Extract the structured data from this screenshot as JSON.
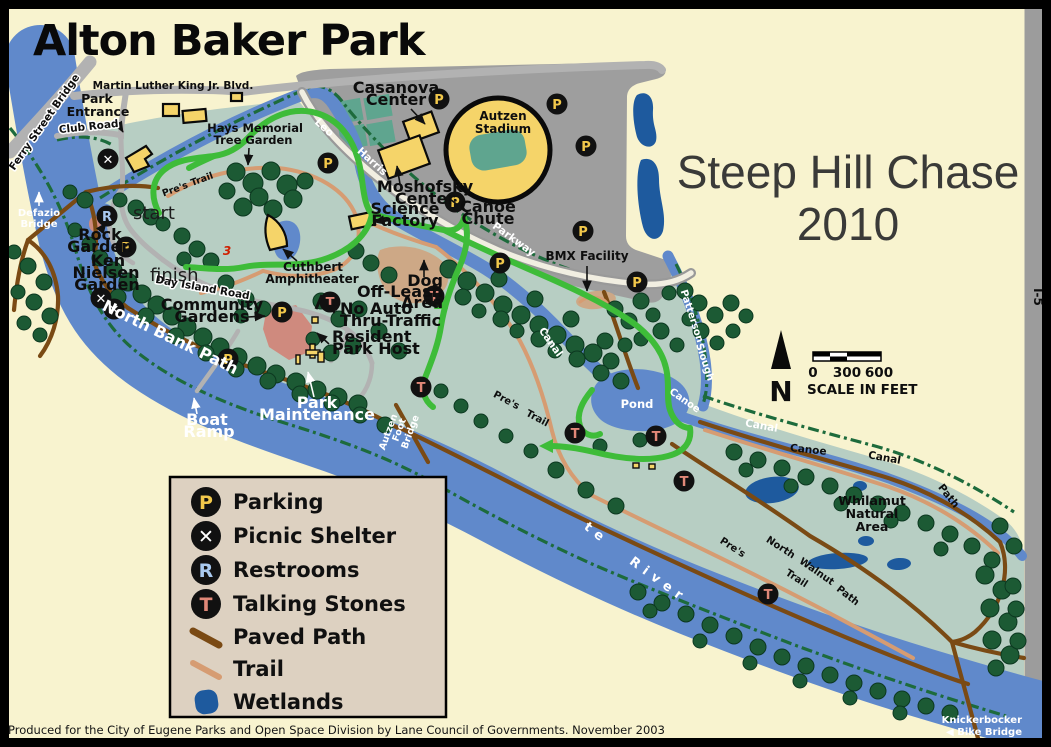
{
  "title": "Alton Baker Park",
  "event_overlay": {
    "line1": "Steep Hill Chase",
    "line2": "2010"
  },
  "credit": "Produced for the City of Eugene Parks and Open Space Division by Lane Council of Governments.  November 2003",
  "symbols": {
    "parking": "P",
    "picnic": "✕",
    "restroom": "R",
    "talking": "T"
  },
  "legend": {
    "items": [
      {
        "symbol": "P",
        "label": "Parking"
      },
      {
        "symbol": "✕",
        "label": "Picnic Shelter"
      },
      {
        "symbol": "R",
        "label": "Restrooms"
      },
      {
        "symbol": "T",
        "label": "Talking Stones"
      },
      {
        "label": "Paved Path"
      },
      {
        "label": "Trail"
      },
      {
        "label": "Wetlands"
      }
    ]
  },
  "compass": {
    "north": "N"
  },
  "scale_bar": {
    "t0": "0",
    "t300": "300",
    "t600": "600",
    "caption": "SCALE IN FEET"
  },
  "route": {
    "start": "start",
    "finish": "finish",
    "marker": "3"
  },
  "labels": {
    "mlk": "Martin Luther King Jr. Blvd.",
    "park_1": "Park",
    "park_2": "Entrance",
    "club_road": "Club Road",
    "ferry": "Ferry Street Bridge",
    "defazio_1": "Defazio",
    "defazio_2": "Bridge",
    "rock_1": "Rock",
    "rock_2": "Garden",
    "ken_1": "Ken",
    "ken_2": "Nielsen",
    "ken_3": "Garden",
    "casanova_1": "Casanova",
    "casanova_2": "Center",
    "autzen_1": "Autzen",
    "autzen_2": "Stadium",
    "moshofsky_1": "Moshofsky",
    "moshofsky_2": "Center",
    "science_1": "Science",
    "science_2": "Factory",
    "chute_1": "Canoe",
    "chute_2": "Chute",
    "leo": "Leo",
    "harris": "Harris",
    "parkway": "Parkway",
    "bmx": "BMX Facility",
    "hays_1": "Hays Memorial",
    "hays_2": "Tree Garden",
    "cuthbert_1": "Cuthbert",
    "cuthbert_2": "Amphitheater",
    "dog_1": "Dog",
    "dog_2": "Off-Leash",
    "dog_3": "Area",
    "community_1": "Community",
    "community_2": "Gardens",
    "noauto_1": "No Auto",
    "noauto_2": "Thru-Traffic",
    "resident_1": "Resident",
    "resident_2": "Park Host",
    "north_bank": "North Bank Path",
    "day_island": "Day Island Road",
    "boat_1": "Boat",
    "boat_2": "Ramp",
    "maint_1": "Park",
    "maint_2": "Maintenance",
    "afb_1": "Autzen",
    "afb_2": "Foot",
    "afb_3": "Bridge",
    "pres": "Pre's",
    "trail": "Trail",
    "canal": "Canal",
    "canoe": "Canoe",
    "pond": "Pond",
    "patterson": "Patterson",
    "slough": "Slough",
    "whilamut_1": "Whilamut",
    "whilamut_2": "Natural",
    "whilamut_3": "Area",
    "north": "North",
    "walnut": "Walnut",
    "path": "Path",
    "willamette": "Willamette",
    "river": "River",
    "knicker_1": "Knickerbocker",
    "knicker_2": "◀ Bike Bridge",
    "i5": "I-5"
  },
  "colors": {
    "cream": "#f8f3cf",
    "sage": "#b7cec3",
    "stadium_gray": "#9e9e9e",
    "water": "#6089cb",
    "wetland": "#1e5a9e",
    "tree": "#1c5a34",
    "paved_path": "#7a4a14",
    "trail": "#d69c72",
    "route": "#3ebc39",
    "building": "#f5d469",
    "field_teal": "#5fa58f",
    "legend_bg": "#ddd1c1",
    "parking_letter": "#f2c84b",
    "restroom_letter": "#a9c9ef",
    "talking_letter": "#e08878"
  }
}
